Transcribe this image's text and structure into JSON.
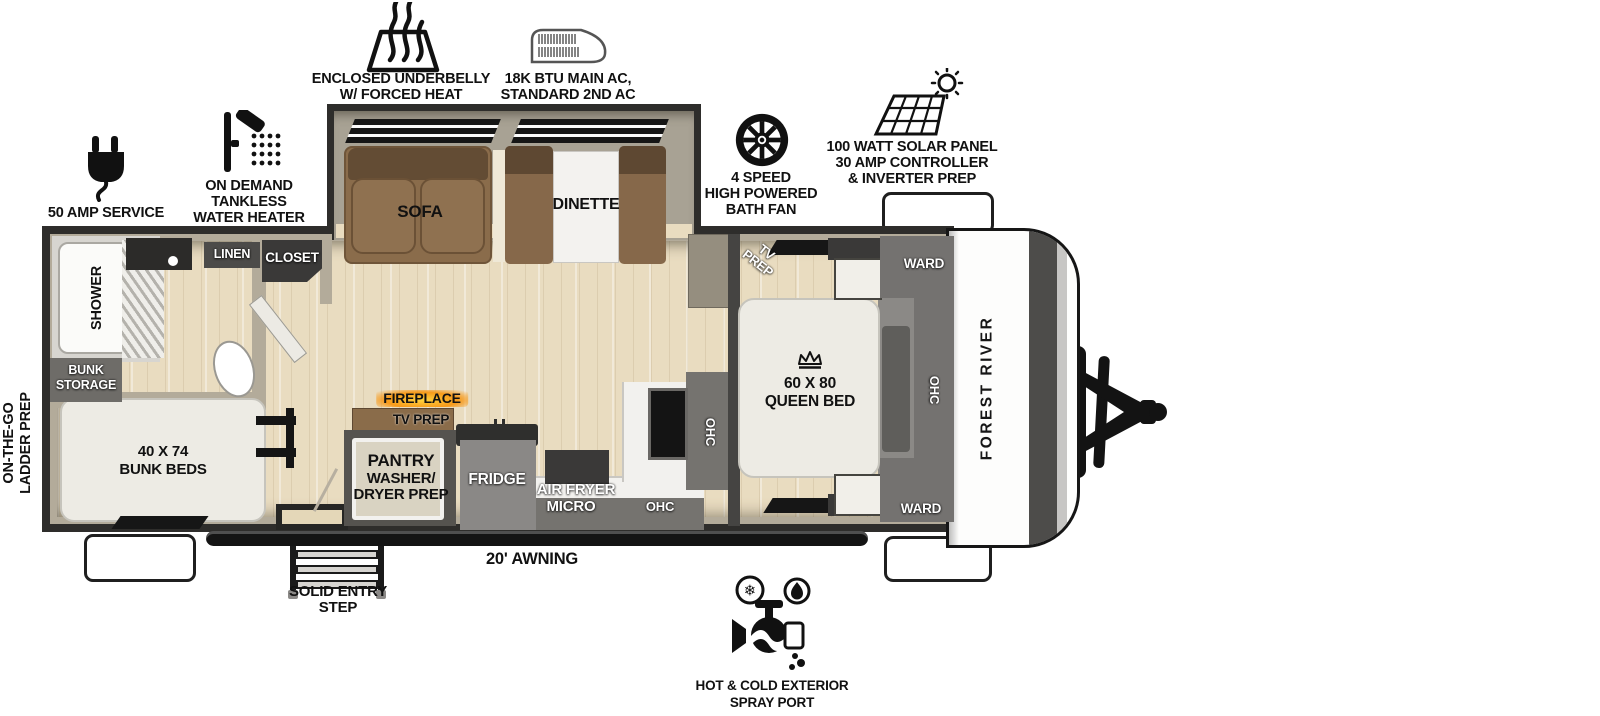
{
  "brand": {
    "name": "FOREST RIVER"
  },
  "colors": {
    "wall_dark": "#2e2d2b",
    "wall_tan": "#b3ab9a",
    "floor_wood": "#e9dcc0",
    "cabinet_gray": "#747270",
    "cabinet_dark": "#3a3938",
    "sofa_brown": "#8a6c4b",
    "fireplace_orange": "#f79a1b",
    "mattress_white": "#edebe4"
  },
  "callouts": {
    "underbelly": {
      "icon": "forced-heat-icon",
      "lines": [
        "ENCLOSED UNDERBELLY",
        "W/ FORCED HEAT"
      ]
    },
    "ac": {
      "icon": "ac-unit-icon",
      "lines": [
        "18K BTU MAIN AC,",
        "STANDARD 2ND AC"
      ]
    },
    "bath_fan": {
      "icon": "bath-fan-icon",
      "lines": [
        "4 SPEED",
        "HIGH POWERED",
        "BATH FAN"
      ]
    },
    "solar": {
      "icon": "solar-panel-icon",
      "lines": [
        "100 WATT SOLAR PANEL",
        "30 AMP CONTROLLER",
        "& INVERTER PREP"
      ]
    },
    "shore_power": {
      "icon": "power-plug-icon",
      "lines": [
        "50 AMP SERVICE"
      ]
    },
    "water_heater": {
      "icon": "shower-head-icon",
      "lines": [
        "ON DEMAND",
        "TANKLESS",
        "WATER HEATER"
      ]
    },
    "ladder_prep": {
      "lines": [
        "ON-THE-GO",
        "LADDER PREP"
      ]
    },
    "awning": {
      "label": "20' AWNING"
    },
    "entry_step": {
      "lines": [
        "SOLID ENTRY",
        "STEP"
      ]
    },
    "spray_port": {
      "icon": "spray-port-icon",
      "lines": [
        "HOT & COLD EXTERIOR",
        "SPRAY PORT"
      ]
    }
  },
  "rooms": {
    "shower": {
      "label": "SHOWER"
    },
    "linen": {
      "label": "LINEN"
    },
    "closet": {
      "label": "CLOSET"
    },
    "bunk_storage": {
      "lines": [
        "BUNK",
        "STORAGE"
      ]
    },
    "bunk_beds": {
      "lines": [
        "40 X 74",
        "BUNK BEDS"
      ]
    },
    "sofa": {
      "label": "SOFA"
    },
    "dinette": {
      "label": "DINETTE"
    },
    "fireplace": {
      "label": "FIREPLACE"
    },
    "tv_prep_living": {
      "label": "TV PREP"
    },
    "pantry": {
      "lines": [
        "PANTRY",
        "WASHER/",
        "DRYER PREP"
      ]
    },
    "fridge": {
      "label": "FRIDGE"
    },
    "air_fryer_micro": {
      "lines": [
        "AIR FRYER",
        "MICRO"
      ]
    },
    "ohc_kitchen_rear": {
      "label": "OHC"
    },
    "ohc_kitchen_wall": {
      "label": "OHC"
    },
    "tv_prep_bedroom": {
      "lines": [
        "TV",
        "PREP"
      ]
    },
    "queen_bed": {
      "lines": [
        "60 X 80",
        "QUEEN BED"
      ]
    },
    "ward_front_top": {
      "label": "WARD"
    },
    "ward_front_bottom": {
      "label": "WARD"
    },
    "ohc_bedroom": {
      "label": "OHC"
    }
  }
}
